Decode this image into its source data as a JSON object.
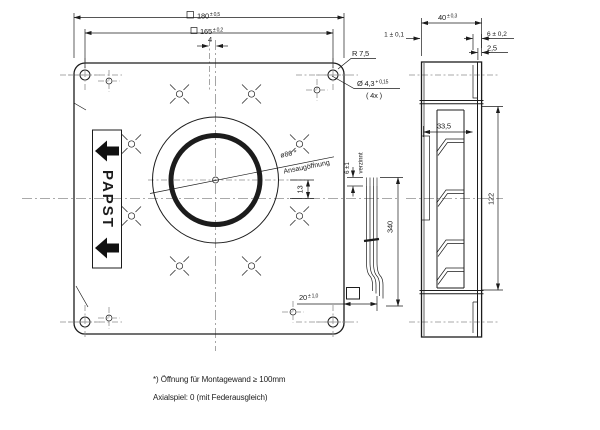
{
  "drawing": {
    "front_view": {
      "dim_outer_square": {
        "value": "180",
        "tol": "± 0,5"
      },
      "dim_hole_pitch": {
        "value": "165",
        "tol": "± 0,2"
      },
      "dim_axis_offset_x": "4",
      "corner_radius": "R 7,5",
      "mounting_hole": {
        "value": "Ø 4,3",
        "tol": "+ 0,15",
        "count": "( 4x )"
      },
      "inlet_diameter": "ø86 *",
      "inlet_label": "Ansaugöffnung",
      "dim_axis_offset_y": "13",
      "dim_cable_offset": {
        "value": "20",
        "tol": "± 1,0"
      },
      "dim_cable_length": "340",
      "dim_strip_length": "6 ±1",
      "strip_finish": "verzinnt",
      "brand": "PAPST"
    },
    "side_view": {
      "dim_depth": {
        "value": "40",
        "tol": "± 0,3"
      },
      "dim_plate_offset": "1 ± 0,1",
      "dim_flange": "6 ± 0,2",
      "dim_plate_thickness": "2,5",
      "dim_impeller_width": "33,5",
      "dim_impeller_diameter": "122"
    },
    "footnotes": [
      "*) Öffnung für Montagewand ≥ 100mm",
      "Axialspiel: 0 (mit Federausgleich)"
    ]
  }
}
